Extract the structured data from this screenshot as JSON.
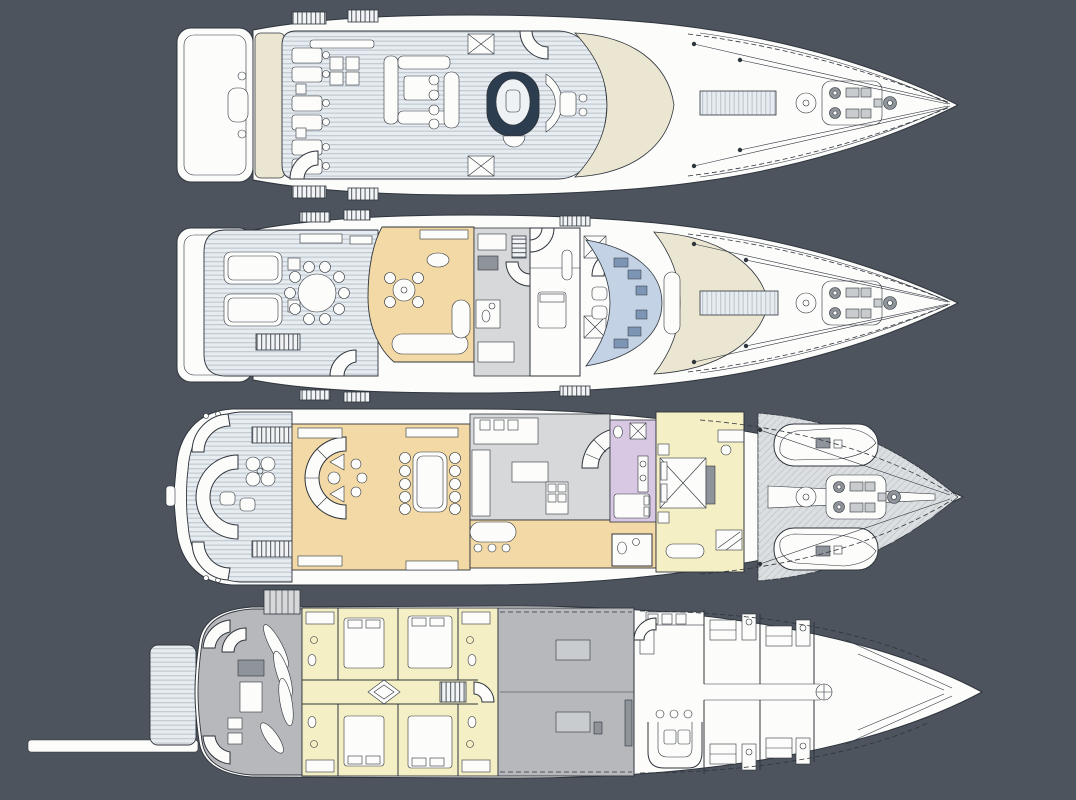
{
  "canvas": {
    "width": 1076,
    "height": 800,
    "background": "#4d545e"
  },
  "colors": {
    "background": "#4d545e",
    "line": "#2f353c",
    "hull-white": "#fcfcfb",
    "cream": "#eae6d2",
    "salon-tan": "#f2d9a5",
    "cabin-yellow": "#f5efc5",
    "bath-lavender": "#d9c8e3",
    "console-blue": "#c3d2e4",
    "console-blue-dark": "#7d95b5",
    "service-gray": "#d6d8da",
    "hold-gray": "#b6b8bc",
    "equip-gray": "#8f949a",
    "teak-base": "#e7ecf0",
    "teak-stripe": "#c3ccd4",
    "foredeck-shade": "#dcdfe2",
    "jacuzzi-dark": "#2c3d4f",
    "water-white": "#eef2f4"
  },
  "decks": [
    {
      "id": "sun-deck"
    },
    {
      "id": "bridge-deck"
    },
    {
      "id": "main-deck"
    },
    {
      "id": "lower-deck"
    }
  ]
}
